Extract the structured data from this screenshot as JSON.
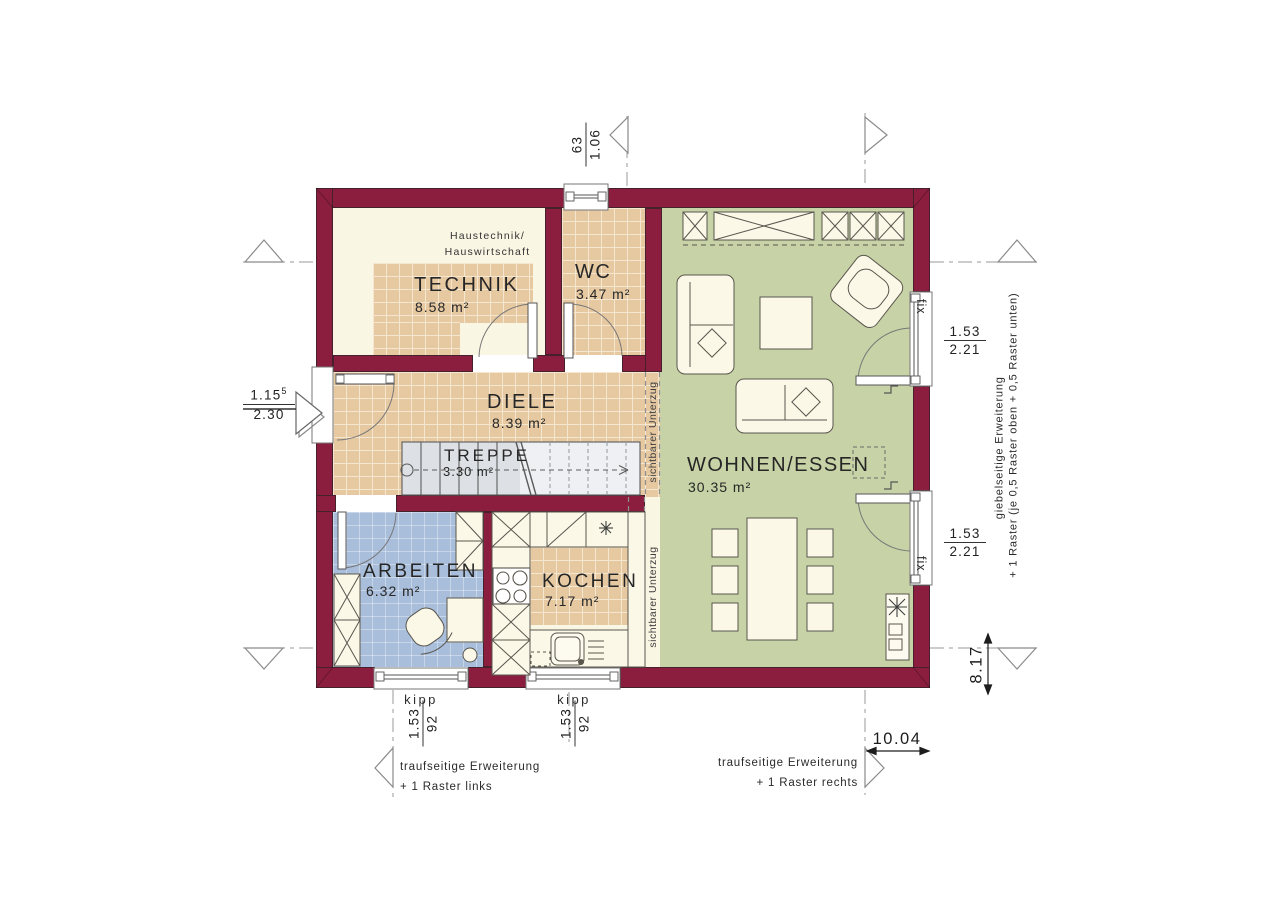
{
  "rooms": {
    "technik": {
      "name": "TECHNIK",
      "area": "8.58 m²",
      "note1": "Haustechnik/",
      "note2": "Hauswirtschaft"
    },
    "wc": {
      "name": "WC",
      "area": "3.47 m²"
    },
    "diele": {
      "name": "DIELE",
      "area": "8.39 m²"
    },
    "treppe": {
      "name": "TREPPE",
      "area": "3.30 m²"
    },
    "arbeiten": {
      "name": "ARBEITEN",
      "area": "6.32 m²"
    },
    "kochen": {
      "name": "KOCHEN",
      "area": "7.17 m²"
    },
    "wohnen": {
      "name": "WOHNEN/ESSEN",
      "area": "30.35 m²"
    }
  },
  "beams": {
    "upper": "sichtbarer Unterzug",
    "lower": "sichtbarer Unterzug"
  },
  "windows": {
    "fix_upper": "fix",
    "fix_lower": "fix",
    "kipp_left": "kipp",
    "kipp_right": "kipp"
  },
  "dimensions": {
    "top_window": {
      "num": "63",
      "den": "1.06"
    },
    "entrance": {
      "base": "1.15",
      "sup": "5",
      "den": "2.30"
    },
    "fix_upper": {
      "num": "1.53",
      "den": "2.21"
    },
    "fix_lower": {
      "num": "1.53",
      "den": "2.21"
    },
    "kipp_left": {
      "num": "1.53",
      "den": "92"
    },
    "kipp_right": {
      "num": "1.53",
      "den": "92"
    },
    "total_width": "10.04",
    "total_depth": "8.17"
  },
  "annotations": {
    "eaves_left_1": "traufseitige Erweiterung",
    "eaves_left_2": "+ 1 Raster links",
    "eaves_right_1": "traufseitige Erweiterung",
    "eaves_right_2": "+ 1 Raster rechts",
    "gable_1": "giebelseitige Erweiterung",
    "gable_2": "+ 1 Raster (je 0,5 Raster oben + 0,5 Raster unten)"
  },
  "colors": {
    "wall": "#8b1e3e",
    "tile_floor": "#e6c8a1",
    "tile_grout": "#f4e6cf",
    "cream_floor": "#faf6e4",
    "living_green": "#c7d2a6",
    "office_blue": "#a9bedb",
    "stair_grey": "#dde1e6",
    "line_dark": "#3c3c3c"
  }
}
